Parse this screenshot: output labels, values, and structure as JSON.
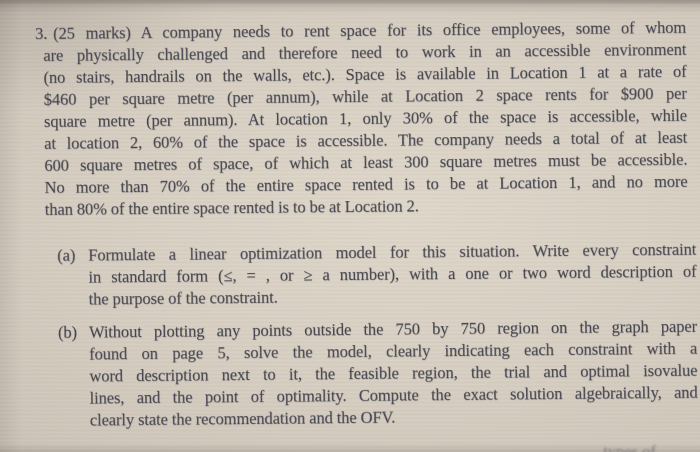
{
  "colors": {
    "paper": "#d6cec1",
    "paper-light": "#ded6c9",
    "ink": "#42434d"
  },
  "question": {
    "number": "3.",
    "lines": [
      "(25 marks) A company needs to rent space for its office employees, some of whom",
      "are physically challenged and therefore need to work in an accessible environment",
      "(no stairs, handrails on the walls, etc.). Space is available in Location 1 at a rate of",
      "$460 per square metre (per annum), while at Location 2 space rents for $900 per",
      "square metre (per annum). At location 1, only 30% of the space is accessible, while",
      "at location 2, 60% of the space is accessible. The company needs a total of at least",
      "600 square metres of space, of which at least 300 square metres must be accessible.",
      "No more than 70% of the entire space rented is to be at Location 1, and no more",
      "than 80% of the entire space rented is to be at Location 2."
    ]
  },
  "part_a": {
    "label": "(a)",
    "lines": [
      "Formulate a linear optimization model for this situation. Write every constraint",
      "in standard form (≤, = , or ≥ a number), with a one or two word description of",
      "the purpose of the constraint."
    ]
  },
  "part_b": {
    "label": "(b)",
    "lines": [
      "Without plotting any points outside the 750 by 750 region on the graph paper",
      "found on page 5, solve the model, clearly indicating each constraint with a",
      "word description next to it, the feasible region, the trial and optimal isovalue",
      "lines, and the point of optimality. Compute the exact solution algebraically, and",
      "clearly state the recommendation and the OFV."
    ]
  },
  "cutoff_fragment": "types of"
}
